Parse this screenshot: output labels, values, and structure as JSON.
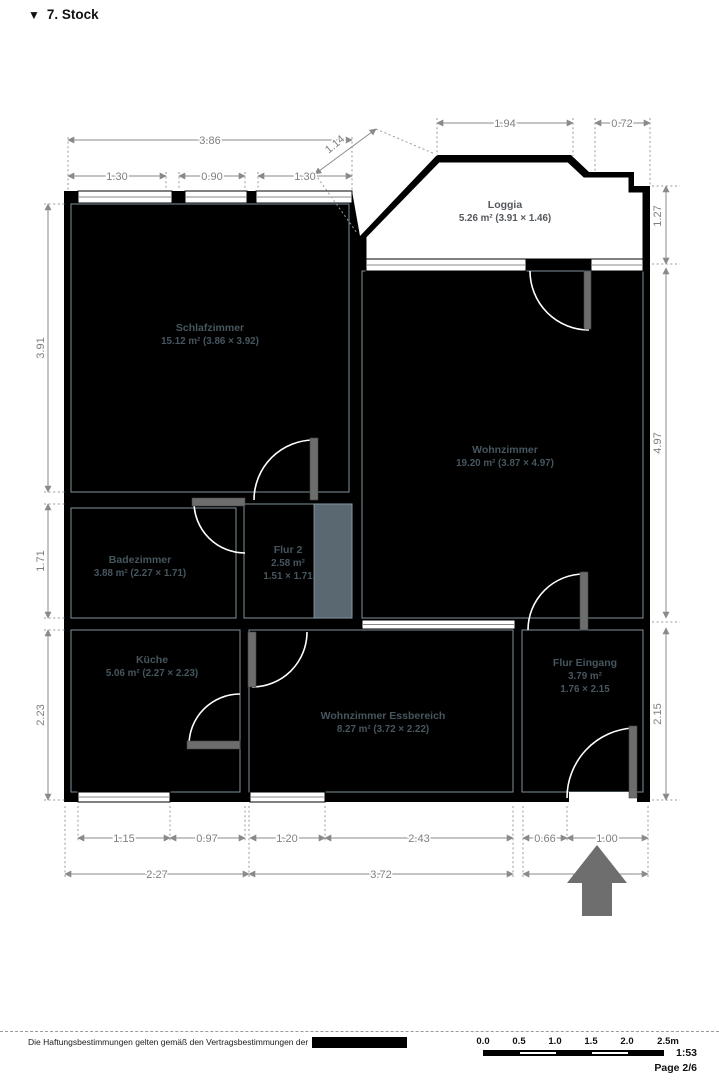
{
  "header": {
    "title": "7. Stock",
    "collapse_icon": "triangle-down"
  },
  "rooms": [
    {
      "name": "Schlafzimmer",
      "details": "15.12 m² (3.86 × 3.92)"
    },
    {
      "name": "Loggia",
      "details": "5.26 m² (3.91 × 1.46)"
    },
    {
      "name": "Wohnzimmer",
      "details": "19.20 m² (3.87 × 4.97)"
    },
    {
      "name": "Badezimmer",
      "details": "3.88 m² (2.27 × 1.71)"
    },
    {
      "name": "Flur 2",
      "details": "2.58 m²",
      "details2": "1.51 × 1.71"
    },
    {
      "name": "Küche",
      "details": "5.06 m² (2.27 × 2.23)"
    },
    {
      "name": "Wohnzimmer Essbereich",
      "details": "8.27 m² (3.72 × 2.22)"
    },
    {
      "name": "Flur Eingang",
      "details": "3.79 m²",
      "details2": "1.76 × 2.15"
    }
  ],
  "dimensions": {
    "top": {
      "w386": "3.86",
      "w114": "1.14",
      "w194": "1.94",
      "w072": "0.72",
      "w130a": "1.30",
      "w090": "0.90",
      "w130b": "1.30"
    },
    "left": {
      "h391": "3.91",
      "h171": "1.71",
      "h223": "2.23"
    },
    "right": {
      "h127": "1.27",
      "h497": "4.97",
      "h215": "2.15"
    },
    "bottom": {
      "w115": "1.15",
      "w097": "0.97",
      "w120": "1.20",
      "w243": "2.43",
      "w066": "0.66",
      "w100": "1.00",
      "w227": "2.27",
      "w372": "3.72",
      "w176": "1.76"
    }
  },
  "footer": {
    "disclaimer": "Die Haftungsbestimmungen gelten gemäß den Vertragsbestimmungen der",
    "scale_ratio": "1:53",
    "page": "Page 2/6",
    "scalebar_labels": [
      "0.0",
      "0.5",
      "1.0",
      "1.5",
      "2.0",
      "2.5m"
    ]
  },
  "colors": {
    "walls": "#000000",
    "door_leaf": "#6d6d6d",
    "room_label": "#46565f",
    "dimension": "#8a8a8a"
  }
}
